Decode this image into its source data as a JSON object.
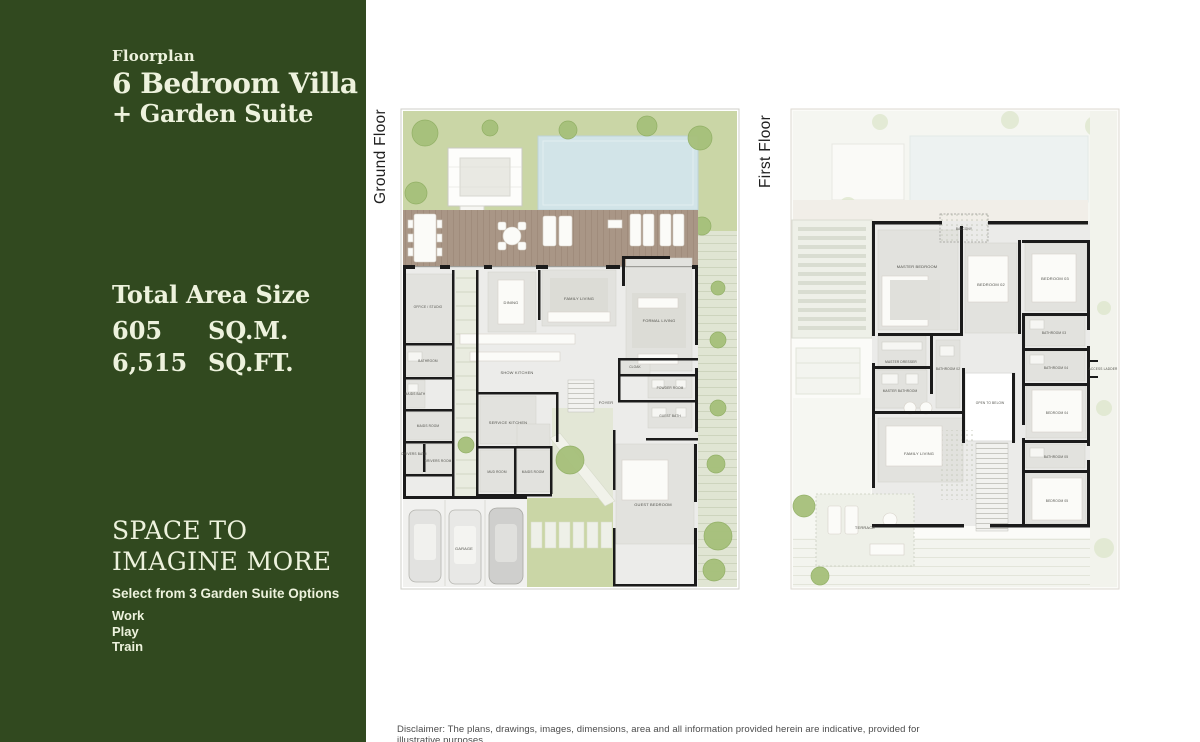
{
  "panel": {
    "eyebrow": "Floorplan",
    "title_line1": "6 Bedroom Villa",
    "title_line2": "+ Garden Suite",
    "area": {
      "heading": "Total Area Size",
      "sqm_value": "605",
      "sqm_unit": "SQ.M.",
      "sqft_value": "6,515",
      "sqft_unit": "SQ.FT."
    },
    "tagline_line1": "SPACE TO",
    "tagline_line2": "IMAGINE MORE",
    "options_heading": "Select from 3 Garden Suite Options",
    "options": [
      "Work",
      "Play",
      "Train"
    ]
  },
  "plans": {
    "ground": {
      "label": "Ground Floor",
      "rooms": {
        "dining": "DINING",
        "family_living": "FAMILY LIVING",
        "formal_living": "FORMAL LIVING",
        "show_kitchen": "SHOW KITCHEN",
        "service_kitchen": "SERVICE KITCHEN",
        "foyer": "FOYER",
        "cloak": "CLOAK",
        "powder_room": "POWDER ROOM",
        "guest_bath": "GUEST BATH",
        "guest_bedroom": "GUEST BEDROOM",
        "office_studio": "OFFICE / STUDIO",
        "bathroom": "BATHROOM",
        "maids_bath": "MAIDS BATH",
        "maids_room": "MAIDS ROOM",
        "drivers_bath": "DRIVERS BATH",
        "drivers_room": "DRIVERS ROOM",
        "mud_room": "MUD ROOM",
        "maids_room_2": "MAIDS ROOM",
        "garage": "GARAGE"
      }
    },
    "first": {
      "label": "First Floor",
      "rooms": {
        "master_bedroom": "MASTER BEDROOM",
        "balcony": "BALCONY",
        "bedroom_02": "BEDROOM 02",
        "bedroom_03": "BEDROOM 03",
        "master_dresser": "MASTER DRESSER",
        "bathroom_02": "BATHROOM 02",
        "bathroom_03": "BATHROOM 03",
        "bathroom_04": "BATHROOM 04",
        "master_bathroom": "MASTER BATHROOM",
        "family_living": "FAMILY LIVING",
        "open_to_below": "OPEN TO BELOW",
        "bedroom_04": "BEDROOM 04",
        "bathroom_05": "BATHROOM 05",
        "bedroom_05": "BEDROOM 05",
        "terrace": "TERRACE",
        "access_ladder": "ACCESS LADDER"
      }
    }
  },
  "disclaimer": "Disclaimer: The plans, drawings, images, dimensions, area and all information provided herein are indicative, provided for illustrative purposes.",
  "colors": {
    "panel_green": "#31491f",
    "cream_text": "#edf2dd",
    "garden_green": "#cad6a6",
    "pool_blue": "#d2e4e8",
    "deck_taupe": "#a99686",
    "wall_black": "#1b1b1b"
  }
}
